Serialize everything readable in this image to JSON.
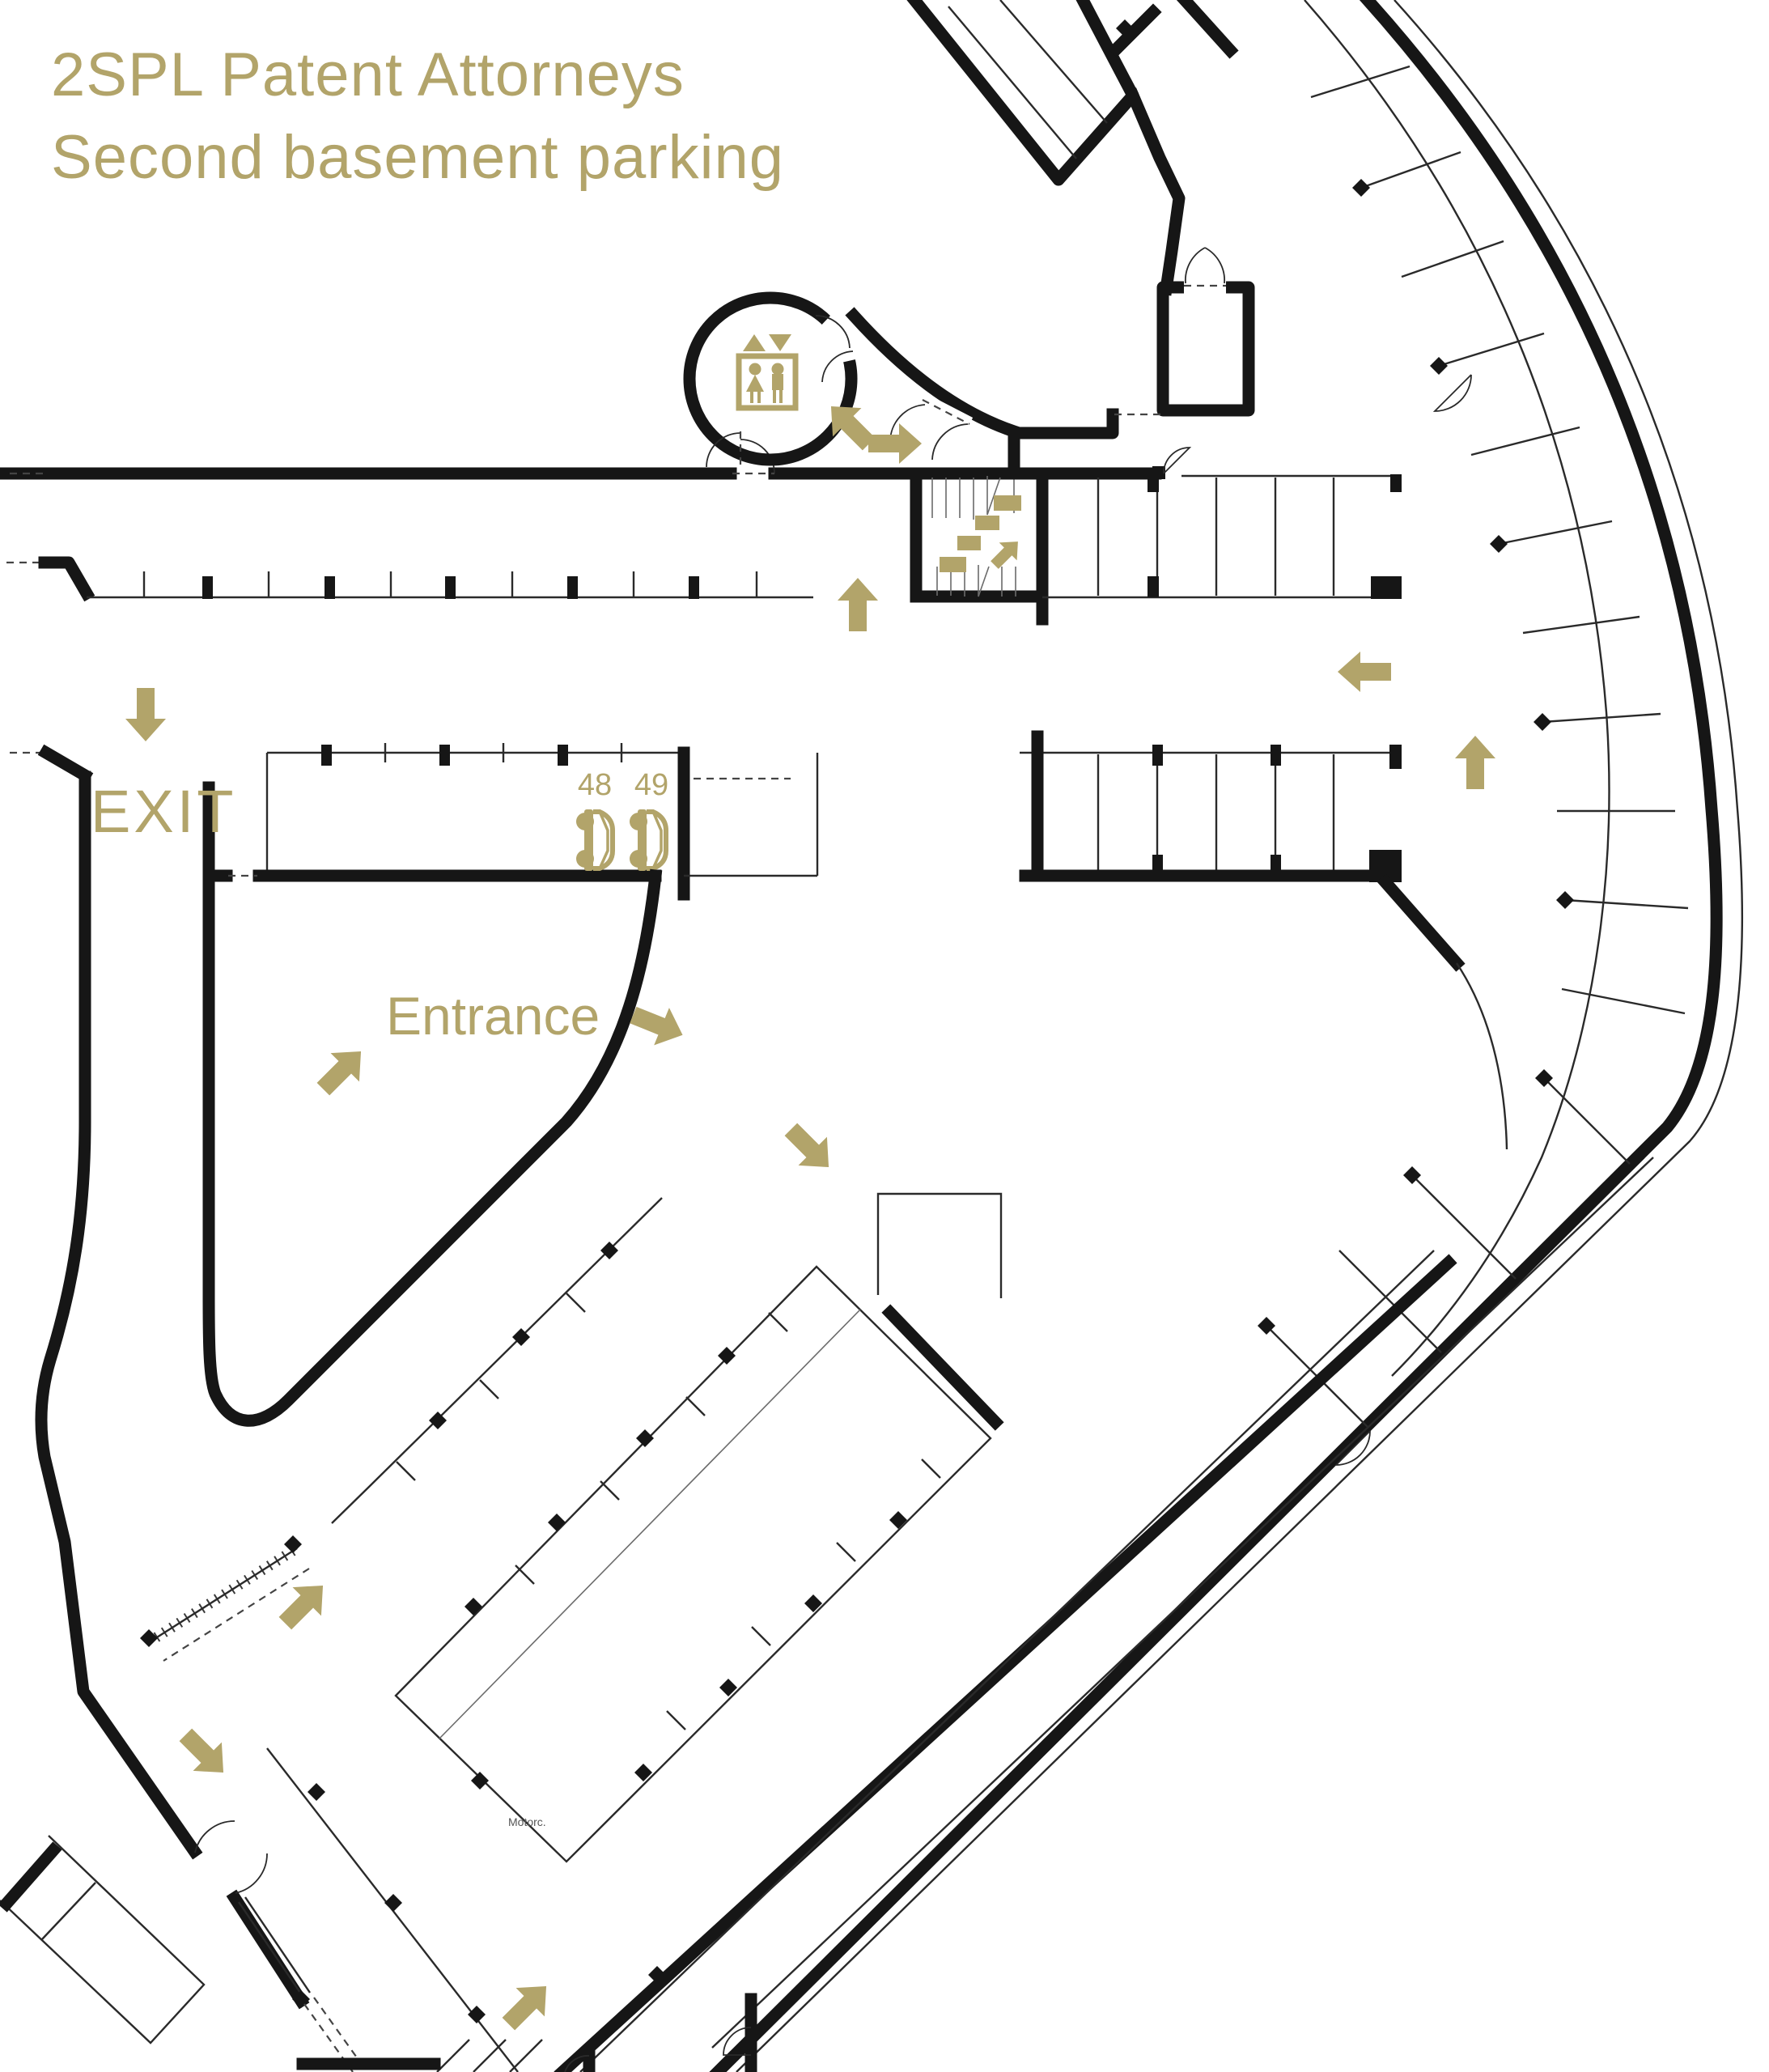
{
  "title": {
    "line1": "2SPL Patent Attorneys",
    "line2": "Second basement parking"
  },
  "labels": {
    "exit": "EXIT",
    "entrance": "Entrance",
    "motorcycle_area": "Motorc."
  },
  "parking_spots": [
    {
      "number": "48"
    },
    {
      "number": "49"
    }
  ],
  "icons": {
    "elevator": "elevator-icon",
    "stairs": "stairs-icon",
    "car": "car-icon",
    "direction_arrow": "direction-arrow-icon"
  },
  "arrows": {
    "directions": [
      "north-west",
      "east",
      "north",
      "west",
      "north",
      "south",
      "north-east",
      "east-south-east",
      "south-east",
      "north-east",
      "south-east",
      "north-east"
    ]
  },
  "theme": {
    "accent_gold": "#b2a46a",
    "wall_black": "#161616",
    "background": "#ffffff"
  }
}
